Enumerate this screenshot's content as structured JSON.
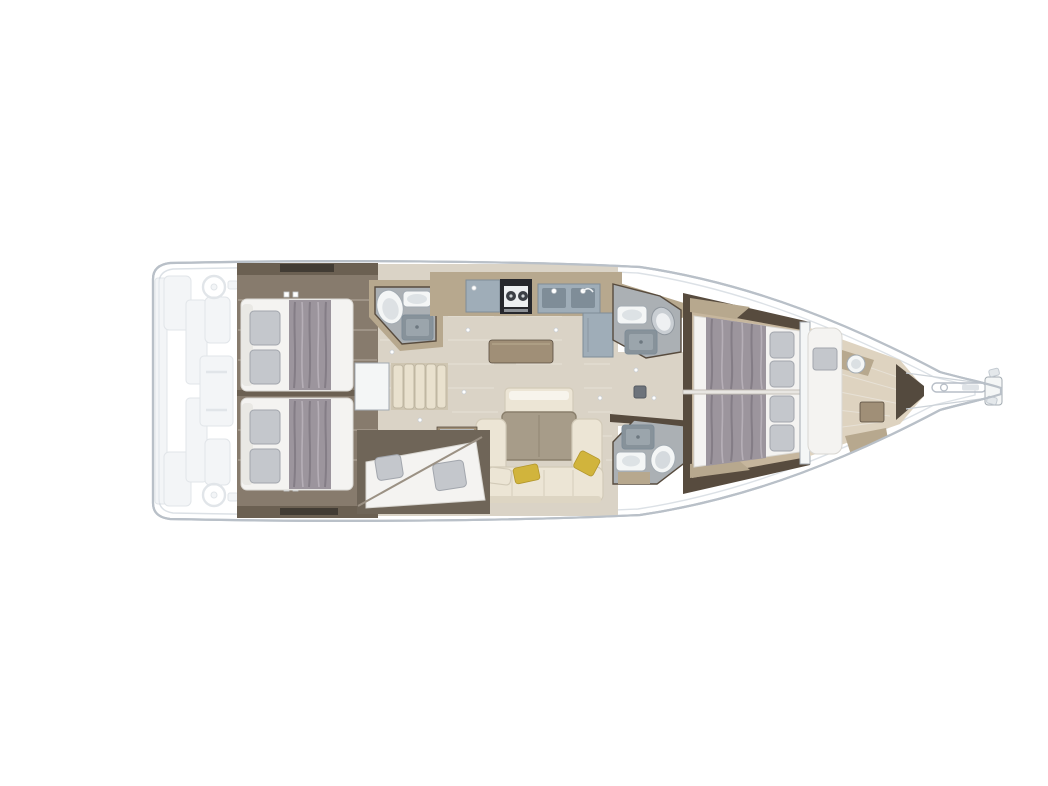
{
  "diagram": {
    "type": "yacht-interior-floor-plan",
    "view": "top-down",
    "orientation": {
      "bow": "right",
      "stern": "left"
    },
    "rooms": [
      {
        "id": "cockpit",
        "ghosted": true,
        "items": [
          "helm-wheel-upper",
          "helm-wheel-lower",
          "cockpit-table",
          "cockpit-benches",
          "transom-platform"
        ]
      },
      {
        "id": "aft-cabin-upper",
        "items": [
          "double-bed",
          "duvet",
          "pillows"
        ]
      },
      {
        "id": "aft-cabin-lower",
        "items": [
          "double-bed",
          "duvet",
          "pillows"
        ]
      },
      {
        "id": "aft-head",
        "items": [
          "toilet",
          "washbasin",
          "shower-tray"
        ]
      },
      {
        "id": "companionway",
        "items": [
          "steps",
          "engine-box"
        ]
      },
      {
        "id": "galley",
        "items": [
          "stove",
          "double-sink",
          "worktop",
          "island-unit",
          "tall-unit"
        ]
      },
      {
        "id": "salon",
        "items": [
          "dining-table",
          "u-shaped-sofa",
          "bench-seat",
          "side-cabinet",
          "accent-pillows"
        ]
      },
      {
        "id": "bunk-cabin-lower",
        "items": [
          "berth",
          "pillows"
        ]
      },
      {
        "id": "mid-head-upper",
        "items": [
          "toilet",
          "washbasin",
          "shower-tray"
        ]
      },
      {
        "id": "mid-head-lower",
        "items": [
          "toilet",
          "washbasin",
          "shower-tray",
          "bench"
        ]
      },
      {
        "id": "forward-cabin",
        "items": [
          "twin-double-beds",
          "duvets",
          "pillows",
          "center-divider",
          "wardrobe"
        ]
      },
      {
        "id": "forepeak-cabin",
        "items": [
          "berth",
          "cushion",
          "washbasin",
          "table",
          "seat"
        ]
      },
      {
        "id": "bow",
        "items": [
          "chain-locker-bulkhead",
          "anchor-channel",
          "bow-roller-plate"
        ]
      }
    ],
    "mast_post": true
  },
  "palette": {
    "hull_fill": "#ffffff",
    "hull_outline": "#b9c0c8",
    "deck_line": "#dce1e6",
    "ghost": "#e9edf0",
    "ghost_line": "#c9d0d7",
    "aft_base": "#877b6d",
    "aft_wall": "#6b6052",
    "aft_dark": "#423c34",
    "mattress": "#f4f3f1",
    "mattress_edge": "#d9d7d2",
    "duvet": "#9c959d",
    "duvet_dark": "#847d86",
    "duvet_light": "#b6afb7",
    "pillow": "#c4c7cc",
    "pillow_line": "#a2a6ad",
    "white_fixture": "#f4f6f6",
    "fixture_stroke": "#a3abb2",
    "steps": "#e9e1ce",
    "steps_dark": "#c0b7a2",
    "wood_tan": "#b7a88e",
    "wood_mid": "#a08f77",
    "wood_dark": "#574b3e",
    "salon_floor": "#dad3c6",
    "salon_floor_line": "#e7e1d6",
    "counter": "#9fadb8",
    "counter_dark": "#7f8d98",
    "stove": "#26272c",
    "head_floor": "#abb0b4",
    "shower": "#87929a",
    "shower_light": "#9ba5ac",
    "sofa": "#ece5d5",
    "sofa_line": "#d2cab8",
    "table": "#a79c89",
    "table_dark": "#8a7f6c",
    "yellow": "#d1b43c",
    "yellow_dark": "#b2962c",
    "fwd_floor": "#c6b69d",
    "forepeak_floor": "#ded3c0",
    "bow_dark": "#544a3e"
  }
}
